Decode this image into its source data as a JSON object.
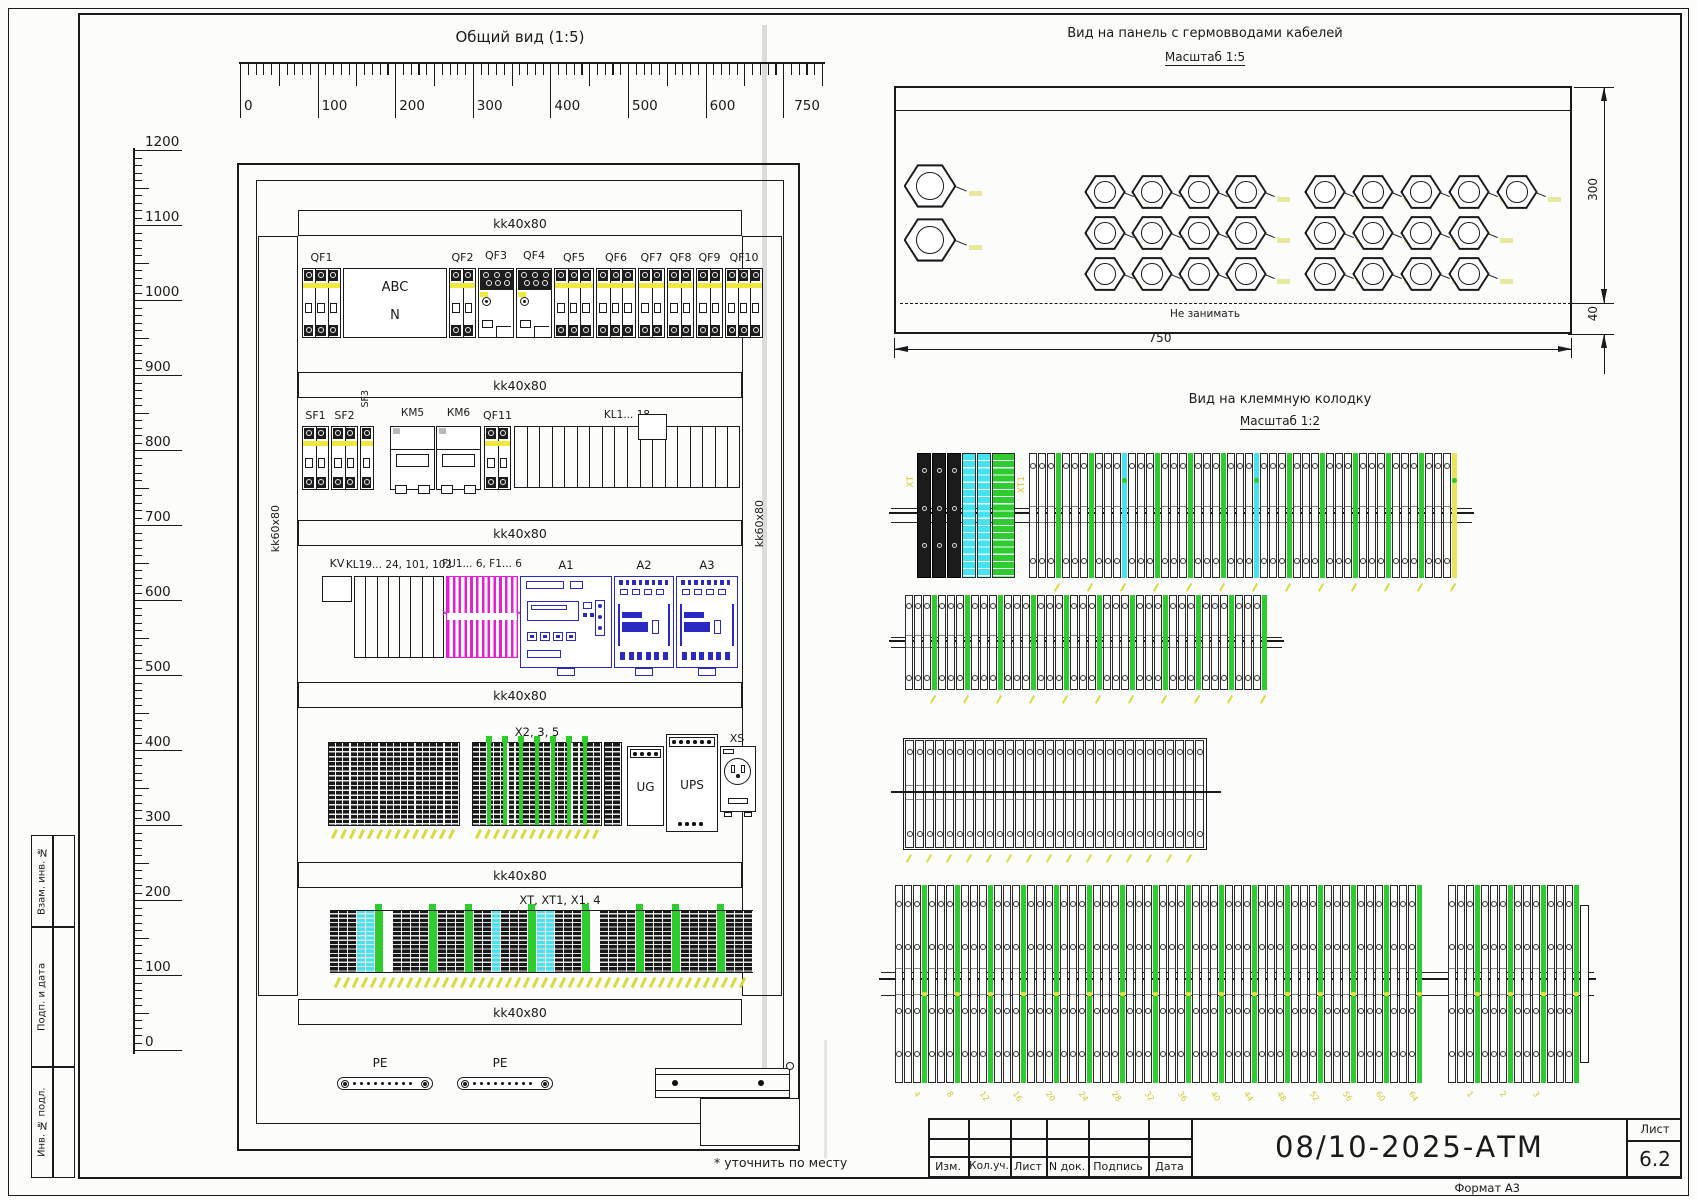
{
  "colors": {
    "ink": "#1a1a1a",
    "yellow": "#f1e83c",
    "magenta": "#e321d2",
    "blue": "#2a2ac2",
    "cyan": "#46e2f0",
    "green": "#2ecc2e",
    "label_yellow": "#d8da3e",
    "crease": "#c6c6c6"
  },
  "general_view": {
    "title": "Общий вид (1:5)",
    "h_ruler": {
      "values": [
        0,
        100,
        200,
        300,
        400,
        500,
        600,
        750
      ],
      "max": 750
    },
    "v_ruler": {
      "values": [
        1200,
        1100,
        1000,
        900,
        800,
        700,
        600,
        500,
        400,
        300,
        200,
        100,
        0
      ],
      "max": 1200
    },
    "rail_label": "kk40x80",
    "side_rail_label": "kk60x80",
    "rows": [
      {
        "y": 268,
        "h": 70,
        "items": [
          {
            "t": "breaker",
            "label": "QF1",
            "x": 302,
            "w": 39,
            "m": 3
          },
          {
            "t": "box2",
            "l1": "ABC",
            "l2": "N",
            "x": 343,
            "w": 104,
            "h": 70
          },
          {
            "t": "breaker",
            "label": "QF2",
            "x": 449,
            "w": 27,
            "m": 2
          },
          {
            "t": "contactor",
            "label": "QF3",
            "x": 478,
            "w": 36
          },
          {
            "t": "contactor",
            "label": "QF4",
            "x": 516,
            "w": 36
          },
          {
            "t": "breaker",
            "label": "QF5",
            "x": 554,
            "w": 40,
            "m": 3
          },
          {
            "t": "breaker",
            "label": "QF6",
            "x": 596,
            "w": 40,
            "m": 3
          },
          {
            "t": "breaker",
            "label": "QF7",
            "x": 638,
            "w": 27,
            "m": 2
          },
          {
            "t": "breaker",
            "label": "QF8",
            "x": 667,
            "w": 27,
            "m": 2
          },
          {
            "t": "breaker",
            "label": "QF9",
            "x": 696,
            "w": 27,
            "m": 2
          },
          {
            "t": "breaker",
            "label": "QF10",
            "x": 725,
            "w": 38,
            "m": 3
          }
        ]
      },
      {
        "y": 426,
        "h": 64,
        "items": [
          {
            "t": "breaker",
            "label": "SF1",
            "x": 302,
            "w": 27,
            "m": 2
          },
          {
            "t": "breaker",
            "label": "SF2",
            "x": 331,
            "w": 27,
            "m": 2
          },
          {
            "t": "breaker",
            "label": "SF3",
            "x": 360,
            "w": 14,
            "m": 1,
            "rot": 1
          },
          {
            "t": "relay",
            "label": "КМ5",
            "x": 390,
            "w": 45
          },
          {
            "t": "relay",
            "label": "КМ6",
            "x": 436,
            "w": 45
          },
          {
            "t": "breaker",
            "label": "QF11",
            "x": 484,
            "w": 27,
            "m": 2
          },
          {
            "t": "comb",
            "label": "KL1... 18",
            "x": 514,
            "w": 226,
            "slots": 18,
            "raised": 10
          }
        ]
      },
      {
        "y": 576,
        "h": 88,
        "items": [
          {
            "t": "kv",
            "label": "KV",
            "x": 322,
            "w": 30
          },
          {
            "t": "comb",
            "label": "KL19... 24, 101, 102",
            "x": 354,
            "w": 90,
            "slots": 8,
            "tall": 1
          },
          {
            "t": "fuse",
            "label": "FU1... 6, F1... 6",
            "x": 446,
            "w": 72
          },
          {
            "t": "plc",
            "label": "A1",
            "x": 520,
            "w": 92
          },
          {
            "t": "module",
            "label": "A2",
            "x": 614,
            "w": 60
          },
          {
            "t": "module",
            "label": "A3",
            "x": 676,
            "w": 62
          }
        ]
      },
      {
        "y": 742,
        "h": 84,
        "items": [
          {
            "t": "tstrip",
            "x": 328,
            "w": 132,
            "cells": 18,
            "tails": 1
          },
          {
            "t": "tstrip",
            "label": "X2, 3, 5",
            "x": 472,
            "w": 130,
            "cells": 18,
            "greens": 7,
            "tails": 1
          },
          {
            "t": "tstrip",
            "x": 604,
            "w": 18,
            "cells": 2
          },
          {
            "t": "ug",
            "label": "UG",
            "x": 627,
            "w": 37
          },
          {
            "t": "ups",
            "label": "UPS",
            "x": 666,
            "w": 52
          },
          {
            "t": "socket",
            "label": "XS",
            "x": 720,
            "w": 36
          }
        ]
      }
    ],
    "row5_label": "XT, XT1, X1, 4",
    "row5_segments": [
      [
        "k",
        3
      ],
      [
        "c",
        2
      ],
      [
        "g",
        1
      ],
      [
        "gap",
        1
      ],
      [
        "k",
        4
      ],
      [
        "g",
        1
      ],
      [
        "k",
        3
      ],
      [
        "g",
        1
      ],
      [
        "k",
        2
      ],
      [
        "c",
        1
      ],
      [
        "k",
        3
      ],
      [
        "g",
        1
      ],
      [
        "c",
        2
      ],
      [
        "k",
        3
      ],
      [
        "g",
        1
      ],
      [
        "gap",
        1
      ],
      [
        "k",
        4
      ],
      [
        "g",
        1
      ],
      [
        "k",
        3
      ],
      [
        "g",
        1
      ],
      [
        "k",
        4
      ],
      [
        "g",
        1
      ],
      [
        "k",
        3
      ]
    ],
    "pe_label": "PE",
    "battery_label": "GB1, GB2",
    "note": "* уточнить по месту"
  },
  "gland_view": {
    "title": "Вид на панель с гермовводами кабелей",
    "scale": "Масштаб 1:5",
    "keep_out": "Не занимать",
    "dim_width": "750",
    "dim_height": "300",
    "dim_gap": "40"
  },
  "terminal_view": {
    "title": "Вид на клеммную колодку",
    "scale": "Масштаб 1:2",
    "labels": {
      "s1_left": "XT",
      "s1_mid": "XT1"
    },
    "s4_numbers": [
      4,
      8,
      12,
      16,
      20,
      24,
      28,
      32,
      36,
      40,
      44,
      48,
      52,
      56,
      60,
      64
    ],
    "s4b_numbers": [
      1,
      2,
      3
    ]
  },
  "title_block": {
    "doc_number": "08/10-2025-АТМ",
    "columns": [
      "Изм.",
      "Кол.уч.",
      "Лист",
      "N док.",
      "Подпись",
      "Дата"
    ],
    "sheet_word": "Лист",
    "sheet_number": "6.2",
    "format": "Формат А3"
  },
  "side_stamps": [
    "Взам. инв. №",
    "Подп. и дата",
    "Инв. № подл."
  ]
}
